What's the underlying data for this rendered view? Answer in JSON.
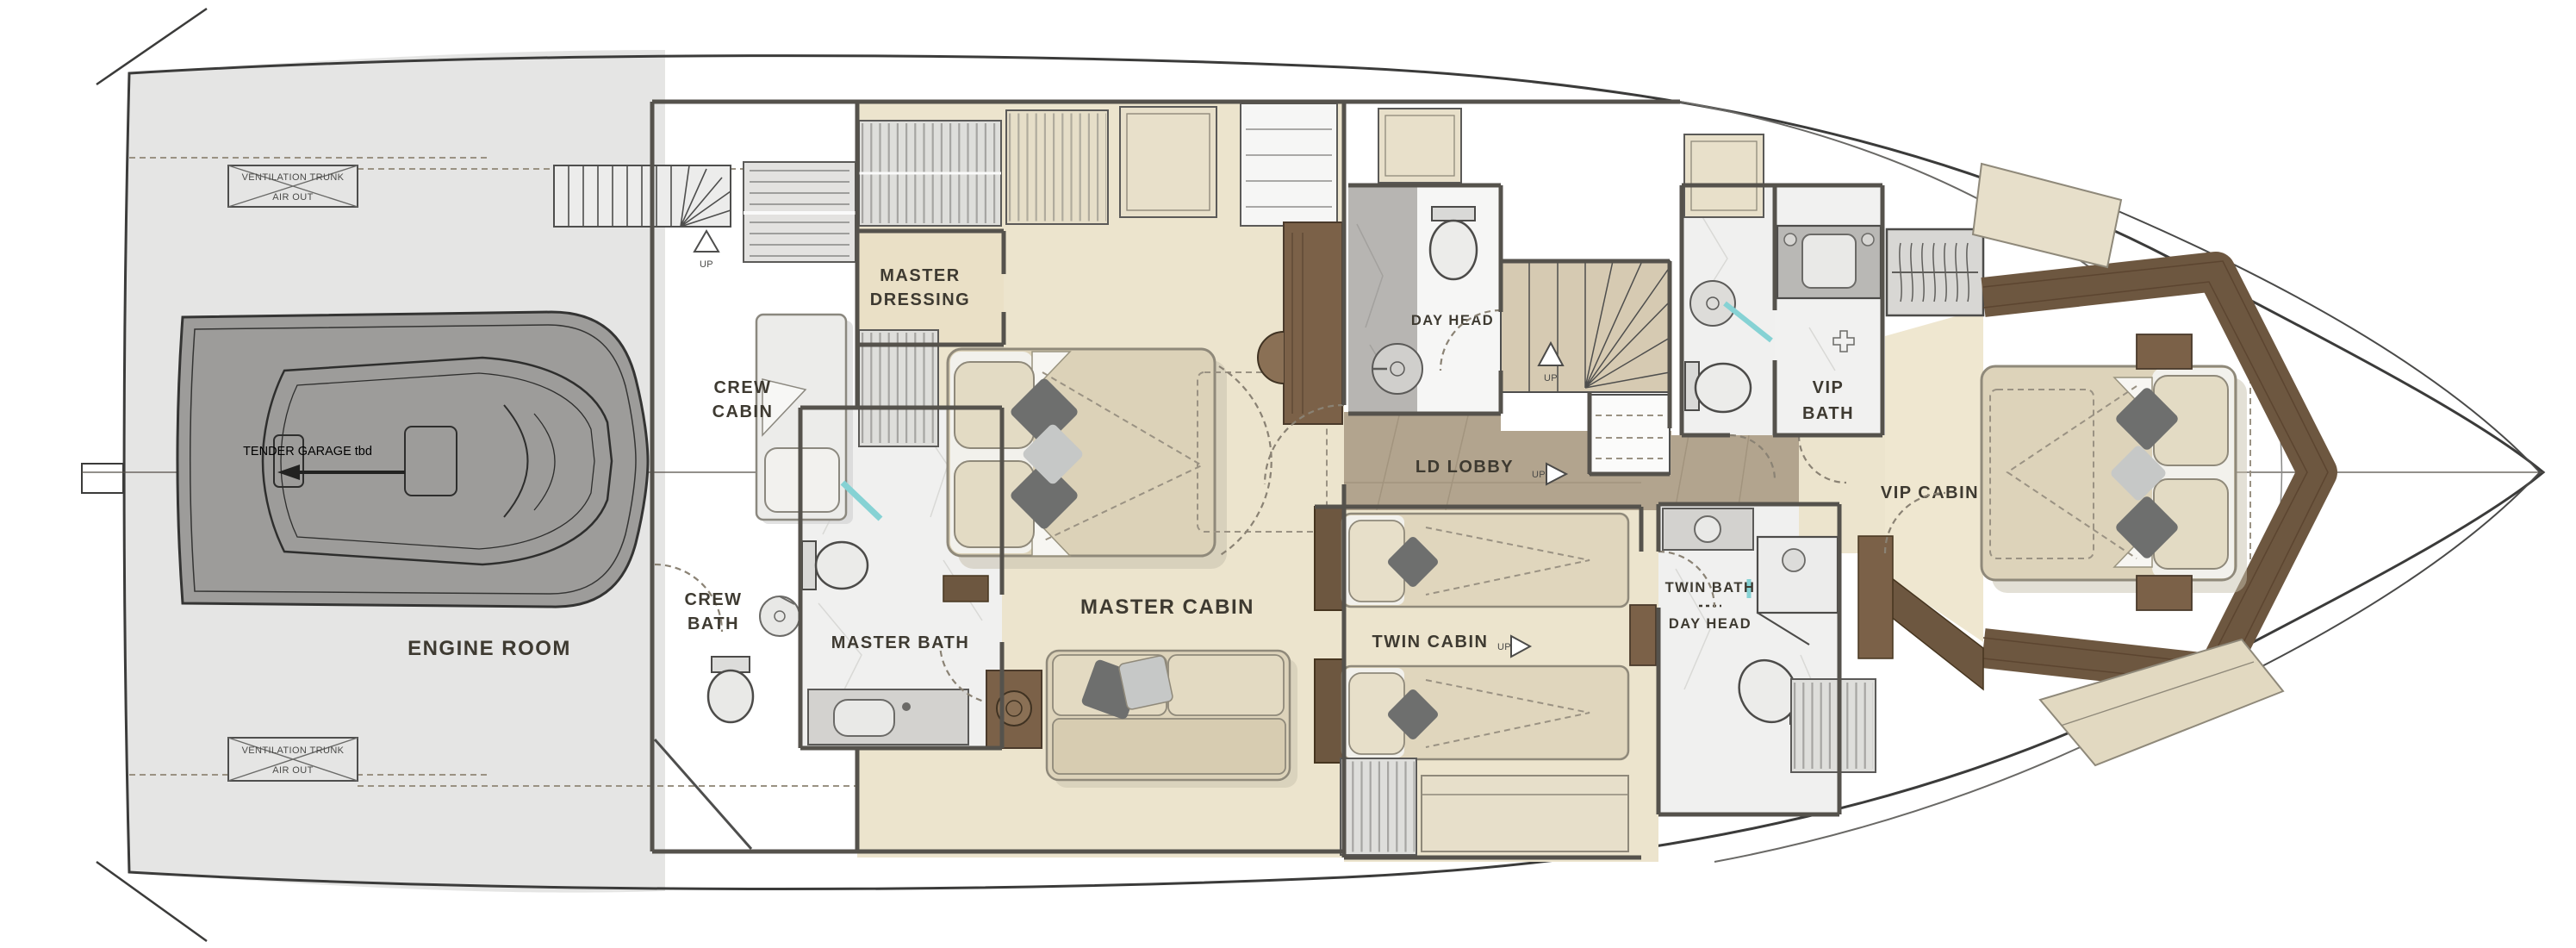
{
  "title": "Yacht Lower Deck Floor Plan",
  "rooms": {
    "engine_room": "ENGINE ROOM",
    "crew_cabin": [
      "CREW",
      "CABIN"
    ],
    "crew_bath": [
      "CREW",
      "BATH"
    ],
    "master_dressing": [
      "MASTER",
      "DRESSING"
    ],
    "master_bath": "MASTER BATH",
    "master_cabin": "MASTER CABIN",
    "day_head_mid": "DAY HEAD",
    "ld_lobby": "LD LOBBY",
    "twin_cabin": "TWIN CABIN",
    "twin_bath": "TWIN BATH",
    "day_head_fwd": "DAY HEAD",
    "vip_bath": [
      "VIP",
      "BATH"
    ],
    "vip_cabin": "VIP CABIN"
  },
  "annotations": {
    "ventilation_trunk": "VENTILATION TRUNK",
    "air_out": "AIR OUT",
    "tender_garage": "TENDER GARAGE tbd",
    "up": "UP"
  },
  "colors": {
    "hull_line": "#3b3b3a",
    "deck_gray": "#e5e5e4",
    "tender_gray": "#9d9c9a",
    "floor_beige": "#ece4cd",
    "floor_dressing": "#eae0c6",
    "lobby_wood": "#b2a48e",
    "stair_tan": "#d6cab2",
    "walnut": "#6d5740",
    "wood_mid": "#7b6148",
    "marble_white": "#f0f0ef",
    "marble_gray": "#b7b5b2",
    "bed_beige": "#ddd3ba",
    "pillow_dark": "#6e6f6e",
    "pillow_light": "#c6c8c7",
    "glass_teal": "#86d2d4",
    "wall": "#55524c",
    "text": "#3e3a31"
  }
}
